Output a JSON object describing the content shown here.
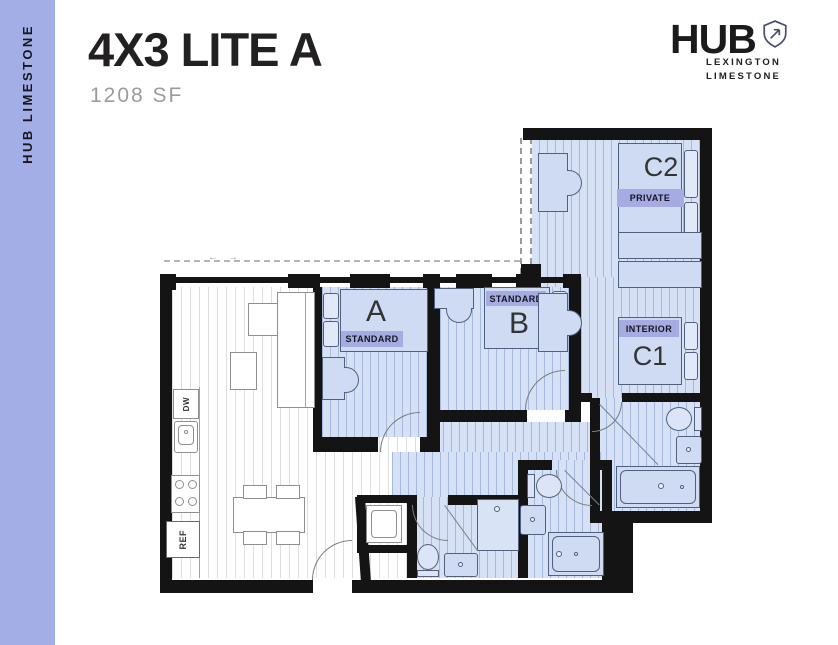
{
  "sidebar": {
    "label": "HUB LIMESTONE"
  },
  "header": {
    "title": "4X3 LITE A",
    "area": "1208 SF"
  },
  "logo": {
    "brand": "HUB",
    "line1": "LEXINGTON",
    "line2": "LIMESTONE"
  },
  "floorplan": {
    "rooms": [
      {
        "id": "A",
        "label": "A",
        "badge": "STANDARD"
      },
      {
        "id": "B",
        "label": "B",
        "badge": "STANDARD"
      },
      {
        "id": "C2",
        "label": "C2",
        "badge": "PRIVATE"
      },
      {
        "id": "C1",
        "label": "C1",
        "badge": "INTERIOR"
      }
    ],
    "appliances": {
      "dishwasher": "DW",
      "refrigerator": "REF"
    },
    "window_arrows": {
      "left": "←",
      "right": "→"
    },
    "colors": {
      "wall": "#141414",
      "bedroom_floor": "#d6e1f5",
      "badge": "#a6ace1",
      "sidebar": "#a3aee6",
      "living_floor": "#ffffff"
    }
  }
}
